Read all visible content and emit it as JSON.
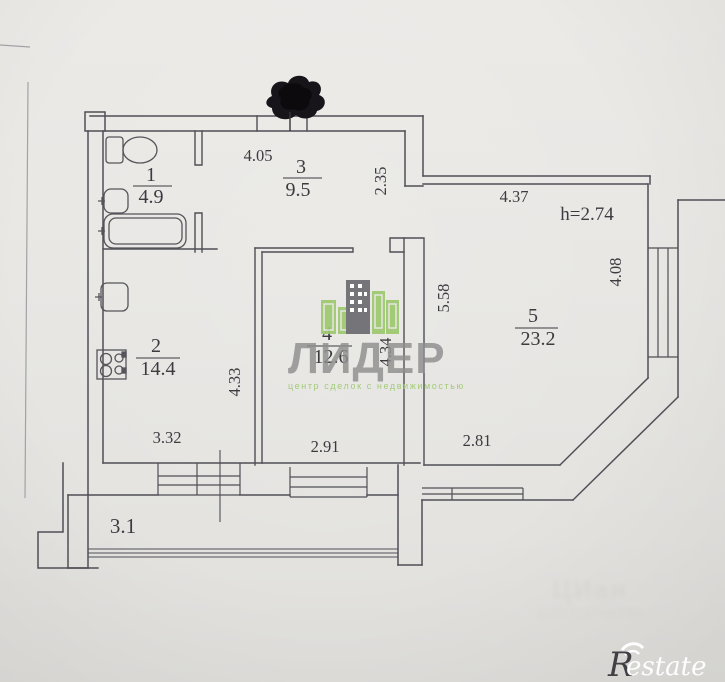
{
  "document": {
    "kind": "apartment floor plan photo",
    "ceiling_height": "h=2.74"
  },
  "rooms": [
    {
      "number": "1",
      "area": "4.9"
    },
    {
      "number": "2",
      "area": "14.4"
    },
    {
      "number": "3",
      "area": "9.5"
    },
    {
      "number": "4",
      "area": "12.6"
    },
    {
      "number": "5",
      "area": "23.2"
    }
  ],
  "balcony": {
    "label": "3.1"
  },
  "dimensions": {
    "hall_width": "4.05",
    "entry_step": "2.35",
    "room5_top": "4.37",
    "room5_right": "4.08",
    "room5_depth": "5.58",
    "room5_bottom": "2.81",
    "room4_width": "2.91",
    "room4_depth": "4.34",
    "kitchen_depth": "4.33",
    "kitchen_width": "3.32"
  },
  "fixtures": [
    "toilet-icon",
    "sink-icon",
    "bathtub-icon",
    "kitchen-sink-icon",
    "stove-icon"
  ],
  "watermark_center": {
    "brand": "ЛИДЕР",
    "tagline": "центр сделок с недвижимостью"
  },
  "watermark_faint": {
    "line1": "ЦИан",
    "line2": "8(913)3796766"
  },
  "watermark_corner": {
    "brand": "estate",
    "initial": "R"
  },
  "colors": {
    "paper": "#e8e7e4",
    "ink": "#4f4f56",
    "watermark_gray": "#8e8e8e",
    "watermark_green": "#9cc86e",
    "logo_white": "#ffffff",
    "marker_black": "#17141a"
  }
}
